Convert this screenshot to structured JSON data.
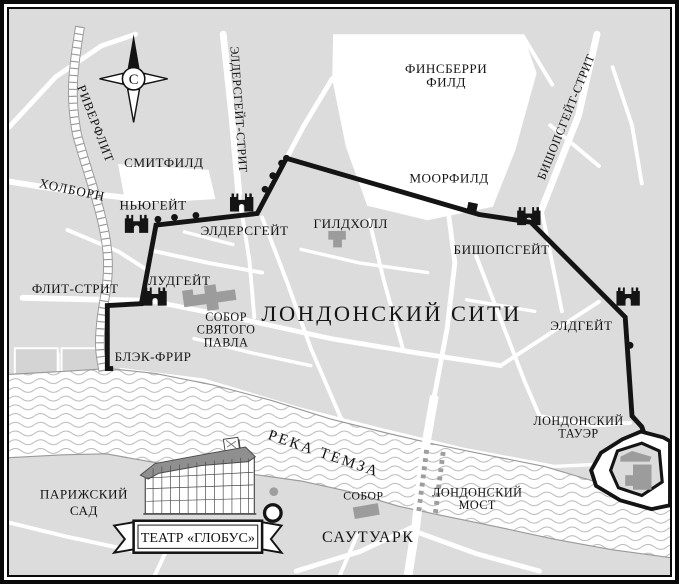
{
  "map_title": "ЛОНДОНСКИЙ СИТИ",
  "theme": {
    "land": "#dcdcdc",
    "street": "#ffffff",
    "ink": "#141414",
    "building": "#9c9c9c",
    "water_line": "#b6b6b6",
    "bank": "#9a9a9a"
  },
  "labels": {
    "riverfleet": "РИВЕРФЛИТ",
    "holborn": "ХОЛБОРН",
    "smithfield": "СМИТФИЛД",
    "aldersgate_street": "ЭЛДЕРСГЕЙТ-СТРИТ",
    "finsbury_line1": "ФИНСБЕРРИ",
    "finsbury_line2": "ФИЛД",
    "moorfield": "МООРФИЛД",
    "bishopsgate_street": "БИШОПСГЕЙТ-СТРИТ",
    "newgate": "НЬЮГЕЙТ",
    "aldersgate": "ЭЛДЕРСГЕЙТ",
    "guildhall": "ГИЛДХОЛЛ",
    "bishopsgate": "БИШОПСГЕЙТ",
    "ludgate": "ЛУДГЕЙТ",
    "fleet_street": "ФЛИТ-СТРИТ",
    "aldgate": "ЭЛДГЕЙТ",
    "st_pauls_line1": "СОБОР",
    "st_pauls_line2": "СВЯТОГО",
    "st_pauls_line3": "ПАВЛА",
    "city_title": "ЛОНДОНСКИЙ СИТИ",
    "blackfriar": "БЛЭК-ФРИР",
    "tower_line1": "ЛОНДОНСКИЙ",
    "tower_line2": "ТАУЭР",
    "thames": "РЕКА ТЕМЗА",
    "paris_garden_line1": "ПАРИЖСКИЙ",
    "paris_garden_line2": "САД",
    "southwark_cathedral": "СОБОР",
    "london_bridge_line1": "ЛОНДОНСКИЙ",
    "london_bridge_line2": "МОСТ",
    "southwark": "САУТУАРК",
    "globe_banner": "ТЕАТР «ГЛОБУС»",
    "compass_north": "С"
  }
}
